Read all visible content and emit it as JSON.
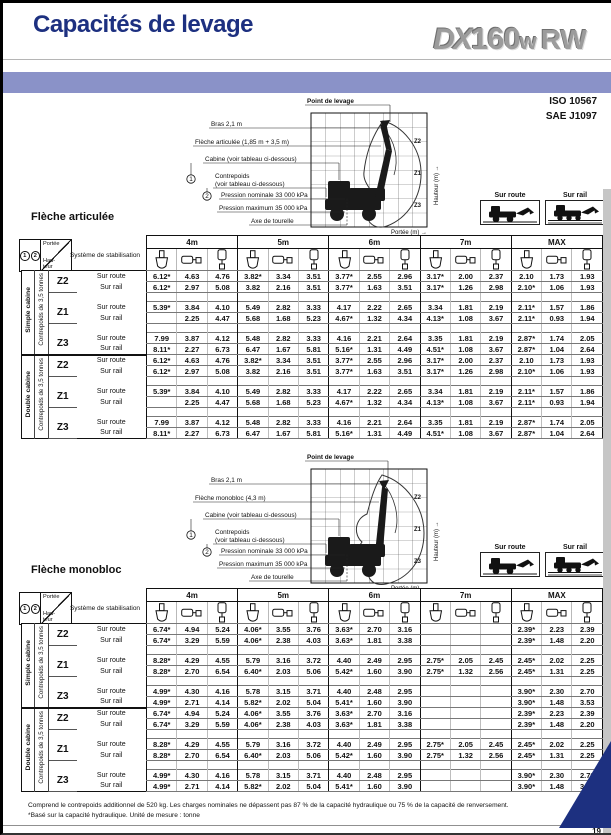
{
  "colors": {
    "accent_band": "#8a92c8",
    "brand_blue": "#1d3080",
    "triangle_blue": "#1d3080"
  },
  "header": {
    "title": "Capacités de levage",
    "logo_dx": "DX",
    "logo_num": "160",
    "logo_w": "w",
    "logo_rw": "RW",
    "standard1": "ISO 10567",
    "standard2": "SAE J1097"
  },
  "mode_boxes": {
    "route": "Sur route",
    "rail": "Sur rail"
  },
  "diagrams": [
    {
      "labels": {
        "point": "Point de levage",
        "bras": "Bras 2,1 m",
        "fleche": "Flèche articulée (1,85 m + 3,5 m)",
        "cabine": "Cabine (voir tableau ci-dessous)",
        "contrepoids_l1": "Contrepoids",
        "contrepoids_l2": "(voir tableau ci-dessous)",
        "pression_nominale": "Pression nominale 33 000 kPa",
        "pression_maximum": "Pression maximum 35 000 kPa",
        "axe": "Axe de tourelle",
        "hauteur": "Hauteur (m) →",
        "portee": "Portée (m) →",
        "z2": "Z2",
        "z1": "Z1",
        "z3": "Z3",
        "num1": "1",
        "num2": "2"
      }
    },
    {
      "labels": {
        "point": "Point de levage",
        "bras": "Bras 2,1 m",
        "fleche": "Flèche monobloc (4,3 m)",
        "cabine": "Cabine (voir tableau ci-dessous)",
        "contrepoids_l1": "Contrepoids",
        "contrepoids_l2": "(voir tableau ci-dessous)",
        "pression_nominale": "Pression nominale 33 000 kPa",
        "pression_maximum": "Pression maximum 35 000 kPa",
        "axe": "Axe de tourelle",
        "hauteur": "Hauteur (m) →",
        "portee": "Portée (m) →",
        "z2": "Z2",
        "z1": "Z1",
        "z3": "Z3",
        "num1": "1",
        "num2": "2"
      }
    }
  ],
  "tables": [
    {
      "name": "Flèche articulée",
      "corner": {
        "one": "1",
        "two": "2",
        "portee": "Portée",
        "hauteur1": "Hau-",
        "hauteur2": "teur",
        "system": "Système de stabilisation"
      },
      "col_groups": [
        "4m",
        "5m",
        "6m",
        "7m",
        "MAX"
      ],
      "stab_icons": [
        "blade-icon",
        "outrigger-side-icon",
        "outrigger-vertical-icon"
      ],
      "row_modes": [
        "Sur route",
        "Sur rail"
      ],
      "groups": [
        {
          "cab": "Simple cabine",
          "cw": "Contrepoids de 3,5 tonnes",
          "zones": [
            {
              "z": "Z2",
              "route": [
                "6.12*",
                "4.63",
                "4.76",
                "3.82*",
                "3.34",
                "3.51",
                "3.77*",
                "2.55",
                "2.96",
                "3.17*",
                "2.00",
                "2.37",
                "2.10",
                "1.73",
                "1.93"
              ],
              "rail": [
                "6.12*",
                "2.97",
                "5.08",
                "3.82",
                "2.16",
                "3.51",
                "3.77*",
                "1.63",
                "3.51",
                "3.17*",
                "1.26",
                "2.98",
                "2.10*",
                "1.06",
                "1.93"
              ]
            },
            {
              "z": "Z1",
              "route": [
                "5.39*",
                "3.84",
                "4.10",
                "5.49",
                "2.82",
                "3.33",
                "4.17",
                "2.22",
                "2.65",
                "3.34",
                "1.81",
                "2.19",
                "2.11*",
                "1.57",
                "1.86"
              ],
              "rail": [
                "",
                "2.25",
                "4.47",
                "5.68",
                "1.68",
                "5.23",
                "4.67*",
                "1.32",
                "4.34",
                "4.13*",
                "1.08",
                "3.67",
                "2.11*",
                "0.93",
                "1.94"
              ]
            },
            {
              "z": "Z3",
              "route": [
                "7.99",
                "3.87",
                "4.12",
                "5.48",
                "2.82",
                "3.33",
                "4.16",
                "2.21",
                "2.64",
                "3.35",
                "1.81",
                "2.19",
                "2.87*",
                "1.74",
                "2.05"
              ],
              "rail": [
                "8.11*",
                "2.27",
                "6.73",
                "6.47",
                "1.67",
                "5.81",
                "5.16*",
                "1.31",
                "4.49",
                "4.51*",
                "1.08",
                "3.67",
                "2.87*",
                "1.04",
                "2.64"
              ]
            }
          ]
        },
        {
          "cab": "Double cabine",
          "cw": "Contrepoids de 3,5 tonnes",
          "zones": [
            {
              "z": "Z2",
              "route": [
                "6.12*",
                "4.63",
                "4.76",
                "3.82*",
                "3.34",
                "3.51",
                "3.77*",
                "2.55",
                "2.96",
                "3.17*",
                "2.00",
                "2.37",
                "2.10",
                "1.73",
                "1.93"
              ],
              "rail": [
                "6.12*",
                "2.97",
                "5.08",
                "3.82",
                "2.16",
                "3.51",
                "3.77*",
                "1.63",
                "3.51",
                "3.17*",
                "1.26",
                "2.98",
                "2.10*",
                "1.06",
                "1.93"
              ]
            },
            {
              "z": "Z1",
              "route": [
                "5.39*",
                "3.84",
                "4.10",
                "5.49",
                "2.82",
                "3.33",
                "4.17",
                "2.22",
                "2.65",
                "3.34",
                "1.81",
                "2.19",
                "2.11*",
                "1.57",
                "1.86"
              ],
              "rail": [
                "",
                "2.25",
                "4.47",
                "5.68",
                "1.68",
                "5.23",
                "4.67*",
                "1.32",
                "4.34",
                "4.13*",
                "1.08",
                "3.67",
                "2.11*",
                "0.93",
                "1.94"
              ]
            },
            {
              "z": "Z3",
              "route": [
                "7.99",
                "3.87",
                "4.12",
                "5.48",
                "2.82",
                "3.33",
                "4.16",
                "2.21",
                "2.64",
                "3.35",
                "1.81",
                "2.19",
                "2.87*",
                "1.74",
                "2.05"
              ],
              "rail": [
                "8.11*",
                "2.27",
                "6.73",
                "6.47",
                "1.67",
                "5.81",
                "5.16*",
                "1.31",
                "4.49",
                "4.51*",
                "1.08",
                "3.67",
                "2.87*",
                "1.04",
                "2.64"
              ]
            }
          ]
        }
      ]
    },
    {
      "name": "Flèche monobloc",
      "corner": {
        "one": "1",
        "two": "2",
        "portee": "Portée",
        "hauteur1": "Hau-",
        "hauteur2": "teur",
        "system": "Système de stabilisation"
      },
      "col_groups": [
        "4m",
        "5m",
        "6m",
        "7m",
        "MAX"
      ],
      "stab_icons": [
        "blade-icon",
        "outrigger-side-icon",
        "outrigger-vertical-icon"
      ],
      "row_modes": [
        "Sur route",
        "Sur rail"
      ],
      "groups": [
        {
          "cab": "Simple cabine",
          "cw": "Contrepoids de 3,5 tonnes",
          "zones": [
            {
              "z": "Z2",
              "route": [
                "6.74*",
                "4.94",
                "5.24",
                "4.06*",
                "3.55",
                "3.76",
                "3.63*",
                "2.70",
                "3.16",
                "",
                "",
                "",
                "2.39*",
                "2.23",
                "2.39"
              ],
              "rail": [
                "6.74*",
                "3.29",
                "5.59",
                "4.06*",
                "2.38",
                "4.03",
                "3.63*",
                "1.81",
                "3.38",
                "",
                "",
                "",
                "2.39*",
                "1.48",
                "2.20"
              ]
            },
            {
              "z": "Z1",
              "route": [
                "8.28*",
                "4.29",
                "4.55",
                "5.79",
                "3.16",
                "3.72",
                "4.40",
                "2.49",
                "2.95",
                "2.75*",
                "2.05",
                "2.45",
                "2.45*",
                "2.02",
                "2.25"
              ],
              "rail": [
                "8.28*",
                "2.70",
                "6.54",
                "6.40*",
                "2.03",
                "5.06",
                "5.42*",
                "1.60",
                "3.90",
                "2.75*",
                "1.32",
                "2.56",
                "2.45*",
                "1.31",
                "2.25"
              ]
            },
            {
              "z": "Z3",
              "route": [
                "4.99*",
                "4.30",
                "4.16",
                "5.78",
                "3.15",
                "3.71",
                "4.40",
                "2.48",
                "2.95",
                "",
                "",
                "",
                "3.90*",
                "2.30",
                "2.70"
              ],
              "rail": [
                "4.99*",
                "2.71",
                "4.14",
                "5.82*",
                "2.02",
                "5.04",
                "5.41*",
                "1.60",
                "3.90",
                "",
                "",
                "",
                "3.90*",
                "1.48",
                "3.53"
              ]
            }
          ]
        },
        {
          "cab": "Double cabine",
          "cw": "Contrepoids de 3,5 tonnes",
          "zones": [
            {
              "z": "Z2",
              "route": [
                "6.74*",
                "4.94",
                "5.24",
                "4.06*",
                "3.55",
                "3.76",
                "3.63*",
                "2.70",
                "3.16",
                "",
                "",
                "",
                "2.39*",
                "2.23",
                "2.39"
              ],
              "rail": [
                "6.74*",
                "3.29",
                "5.59",
                "4.06*",
                "2.38",
                "4.03",
                "3.63*",
                "1.81",
                "3.38",
                "",
                "",
                "",
                "2.39*",
                "1.48",
                "2.20"
              ]
            },
            {
              "z": "Z1",
              "route": [
                "8.28*",
                "4.29",
                "4.55",
                "5.79",
                "3.16",
                "3.72",
                "4.40",
                "2.49",
                "2.95",
                "2.75*",
                "2.05",
                "2.45",
                "2.45*",
                "2.02",
                "2.25"
              ],
              "rail": [
                "8.28*",
                "2.70",
                "6.54",
                "6.40*",
                "2.03",
                "5.06",
                "5.42*",
                "1.60",
                "3.90",
                "2.75*",
                "1.32",
                "2.56",
                "2.45*",
                "1.31",
                "2.25"
              ]
            },
            {
              "z": "Z3",
              "route": [
                "4.99*",
                "4.30",
                "4.16",
                "5.78",
                "3.15",
                "3.71",
                "4.40",
                "2.48",
                "2.95",
                "",
                "",
                "",
                "3.90*",
                "2.30",
                "2.70"
              ],
              "rail": [
                "4.99*",
                "2.71",
                "4.14",
                "5.82*",
                "2.02",
                "5.04",
                "5.41*",
                "1.60",
                "3.90",
                "",
                "",
                "",
                "3.90*",
                "1.48",
                "3.53"
              ]
            }
          ]
        }
      ]
    }
  ],
  "footer": {
    "note1": "Comprend le contrepoids additionnel de 520 kg. Les charges nominales ne dépassent pas 87 % de la capacité hydraulique ou 75 % de la capacité de renversement.",
    "note2": "*Basé sur la capacité hydraulique. Unité de mesure : tonne",
    "page": "19"
  }
}
